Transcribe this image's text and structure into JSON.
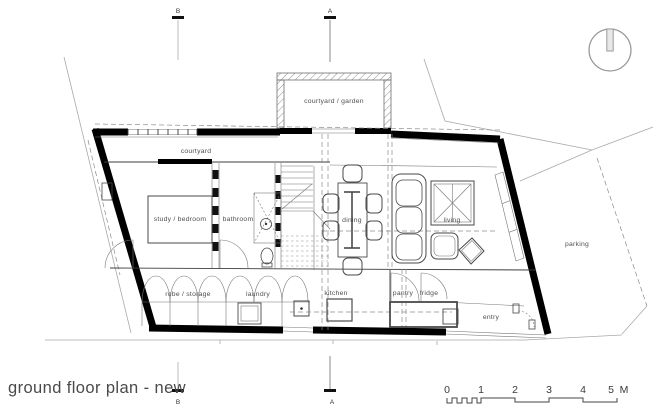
{
  "title": "ground floor plan - new",
  "plan_labels": {
    "courtyard_garden": "courtyard / garden",
    "courtyard": "courtyard",
    "study_bedroom": "study / bedroom",
    "bathroom": "bathroom",
    "dining": "dining",
    "living": "living",
    "robe_storage": "robe / storage",
    "laundry": "laundry",
    "kitchen": "kitchen",
    "pantry": "pantry",
    "fridge": "fridge",
    "entry": "entry",
    "parking": "parking"
  },
  "section_markers": {
    "a": "A",
    "b": "B"
  },
  "scale_bar": {
    "ticks": [
      "0",
      "1",
      "2",
      "3",
      "4",
      "5"
    ],
    "unit": "M"
  },
  "colors": {
    "wall": "#000000",
    "line": "#3c3c3c",
    "site": "#a9a9a9",
    "label": "#4f4f4f"
  }
}
